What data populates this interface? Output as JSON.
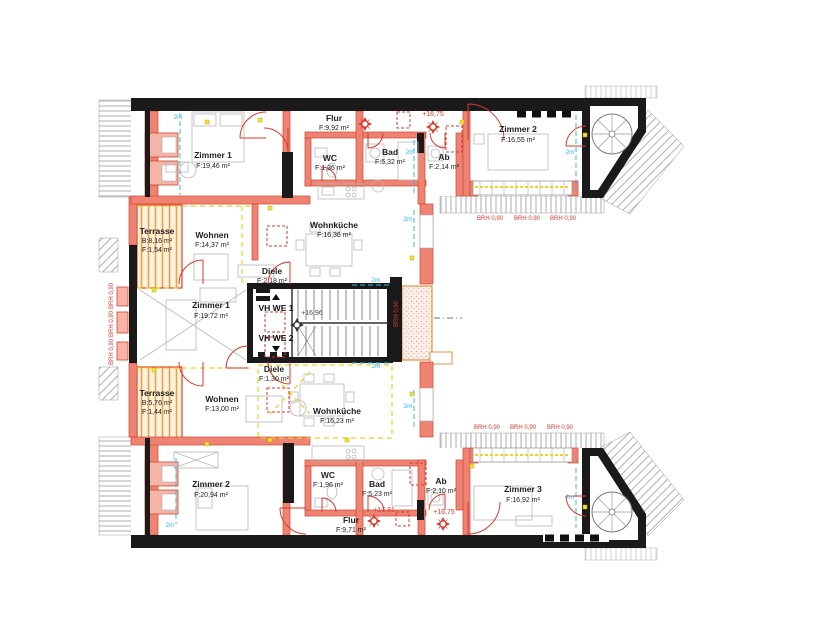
{
  "plan": {
    "type": "attic floor plan, two apartments",
    "colors": {
      "wall_new": "#ee8373",
      "wall_new_edge": "#cf4631",
      "wall_existing": "#1a1a1a",
      "roof_hatch": "#999999",
      "terrace_deck": "#e5a14b",
      "annotation_red": "#d93a2b",
      "headroom_cyan": "#2fb3e8",
      "electric_yellow": "#f2d219"
    }
  },
  "rooms": {
    "we1": {
      "zimmer1": {
        "name": "Zimmer 1",
        "area": "F:19,46 m²"
      },
      "flur": {
        "name": "Flur",
        "area": "F:9,92 m²"
      },
      "wc": {
        "name": "WC",
        "area": "F:1,36 m²"
      },
      "bad": {
        "name": "Bad",
        "area": "F:5,32 m²"
      },
      "ab": {
        "name": "Ab",
        "area": "F:2,14 m²"
      },
      "zimmer2": {
        "name": "Zimmer 2",
        "area": "F:16,55 m²"
      },
      "terrasse": {
        "name": "Terrasse",
        "b": "B:8,16 m²",
        "area": "F:1,54 m²"
      },
      "wohnen": {
        "name": "Wohnen",
        "area": "F:14,37 m²"
      },
      "wohnkueche": {
        "name": "Wohnküche",
        "area": "F:16,36 m²"
      },
      "diele": {
        "name": "Diele",
        "area": "F:2,18 m²"
      }
    },
    "we2": {
      "zimmer1": {
        "name": "Zimmer 1",
        "area": "F:19,72 m²"
      },
      "terrasse": {
        "name": "Terrasse",
        "b": "B:5,76 m²",
        "area": "F:1,44 m²"
      },
      "wohnen": {
        "name": "Wohnen",
        "area": "F:13,00 m²"
      },
      "wohnkueche": {
        "name": "Wohnküche",
        "area": "F:16,23 m²"
      },
      "diele": {
        "name": "Diele",
        "area": "F:1,30 m²"
      },
      "zimmer2": {
        "name": "Zimmer 2",
        "area": "F:20,94 m²"
      },
      "wc": {
        "name": "WC",
        "area": "F:1,96 m²"
      },
      "bad": {
        "name": "Bad",
        "area": "F:5,23 m²"
      },
      "ab": {
        "name": "Ab",
        "area": "F:2,10 m²"
      },
      "flur": {
        "name": "Flur",
        "area": "F:9,71 m²"
      },
      "zimmer3": {
        "name": "Zimmer 3",
        "area": "F:16,92 m²"
      }
    }
  },
  "stairwell": {
    "vh_we1": "VH WE 1",
    "vh_we2": "VH WE 2",
    "level_mid": "+16,96"
  },
  "annotations": {
    "level_top": "+16,75",
    "level_bottom_left": "+17,31",
    "level_bottom_right": "+16,75",
    "brh": "BRH 0,90",
    "two_m": "2m"
  }
}
